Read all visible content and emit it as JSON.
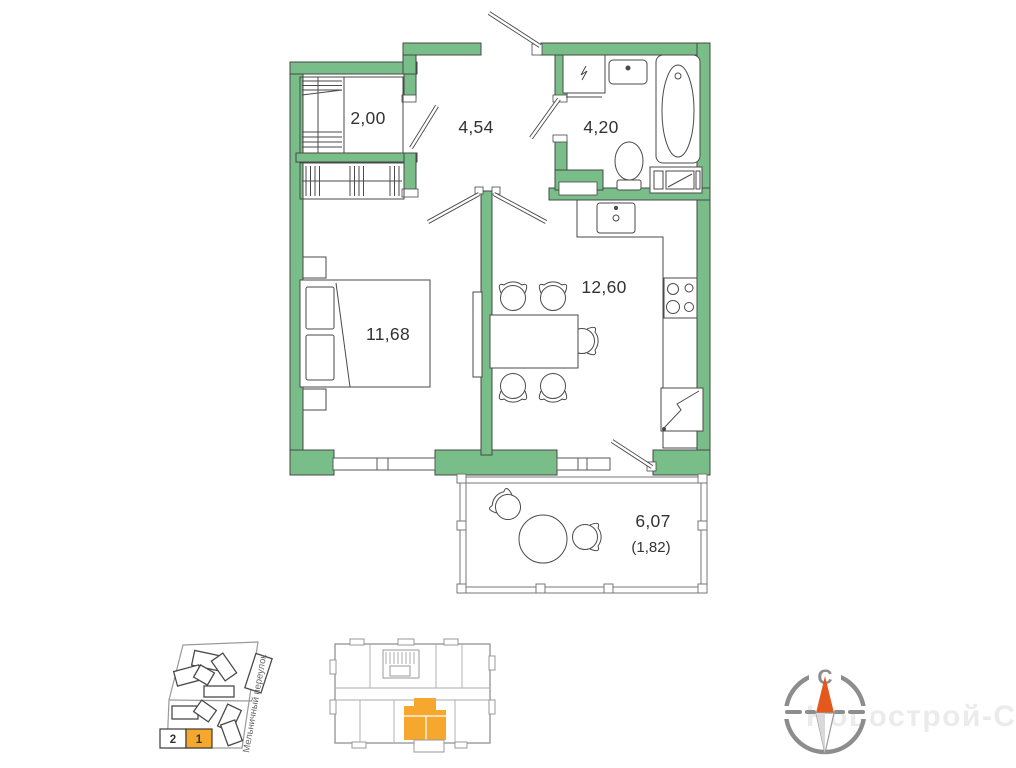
{
  "floor_plan": {
    "wall_color": "#79bd88",
    "rooms": {
      "storage": {
        "area": "2,00"
      },
      "hallway": {
        "area": "4,54"
      },
      "bathroom": {
        "area": "4,20"
      },
      "bedroom": {
        "area": "11,68"
      },
      "kitchen_living": {
        "area": "12,60"
      },
      "balcony": {
        "area": "6,07",
        "area_coeff": "(1,82)"
      }
    }
  },
  "site_plan": {
    "street_label": "Мельничный переулок",
    "badge": {
      "left_value": "2",
      "right_value": "1"
    },
    "highlight_color": "#f5a82d"
  },
  "floor_overview": {
    "unit_color": "#f5a82d"
  },
  "compass": {
    "north_label": "С",
    "needle_color": "#e4571d"
  },
  "watermark": {
    "text": "Новострой-СПб",
    "color": "#ebebeb"
  }
}
